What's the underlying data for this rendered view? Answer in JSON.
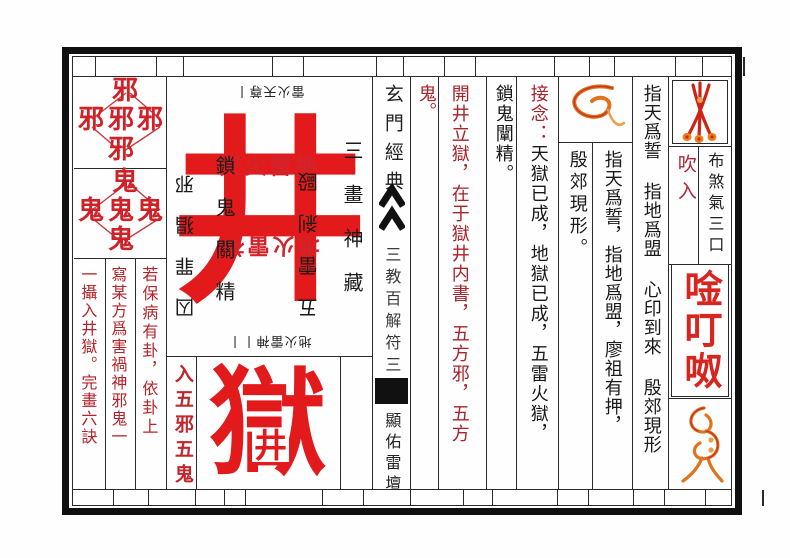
{
  "colors": {
    "bright_red": "#e31a1c",
    "dark_red_text": "#a8232b",
    "mid_red": "#c0272d",
    "sigil_orange": "#e0731c",
    "sigil_red": "#cf2415",
    "ink": "#1a1a1a"
  },
  "left_block": {
    "xie_char": "邪",
    "gui_char": "鬼",
    "col_right": "若保病有卦，依卦上",
    "col_middle": "寫某方爲害禍神邪鬼一",
    "col_left": "一攝入井獄。完畫六訣"
  },
  "talisman": {
    "top_sigil_text": "雷火天尊丨",
    "main_char": "井",
    "row_red": "天火雷神",
    "row_red_inverted": "地火雷神",
    "col_left_outer_inverted": "囚罪猖邪",
    "col_left_inner": "鎖鬼關精",
    "col_right_inner_inverted": "五雷剎毆",
    "col_right_outer": "三畫神藏",
    "bottom_sigil_text": "地火雷神丨丨",
    "lower_label": "入五邪五鬼",
    "prison_char": "獄",
    "prison_inset_char": "井"
  },
  "seal_column": {
    "title": "玄門經典",
    "chevron_icon": "double-chevron-up",
    "body": "三教百解符三",
    "altar": "顯佑雷壇"
  },
  "instruction_columns": {
    "overflow": "鬼。",
    "open_well": "開井立獄，在于獄井内書，五方邪，五方",
    "lock_ghost": "鎖鬼闡精。",
    "recite_label": "接念：",
    "recite_body": "天獄已成，地獄已成，五雷火獄，",
    "yin_jiao": "殷郊現形。",
    "oath_short": "指天爲誓，指地爲盟，廖祖有押，",
    "oath_long": "指天爲誓 指地爲盟 心印到來 殷郊現形"
  },
  "right_panel": {
    "needles_sigil_icon": "crossed-strokes-sigil",
    "loop_sigil_icon": "loop-sigil",
    "blow": "吹入",
    "breath": "布煞氣三口",
    "mantra": "唫叮呶",
    "swirl_sigil_icon": "swirl-sigil"
  }
}
